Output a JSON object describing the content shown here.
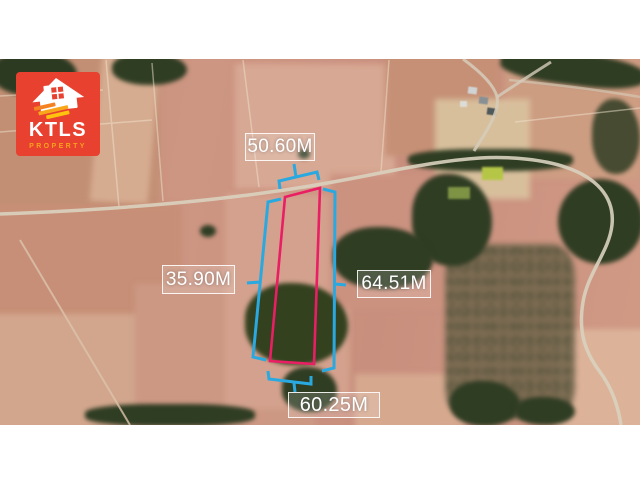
{
  "image": {
    "type": "satellite-property-listing"
  },
  "logo": {
    "brand": "KTLS",
    "tagline": "PROPERTY",
    "background_color": "#e8412f",
    "icon": "house-icon",
    "brand_color": "#ffffff",
    "tagline_color": "#f9a11d",
    "stripe_colors": [
      "#f58220",
      "#faa61a",
      "#ffc20e"
    ]
  },
  "annotations": {
    "dimension_color": "#2aa9e0",
    "boundary_color": "#e91e63",
    "label_text_color": "#ffffff",
    "labels": {
      "top": "50.60M",
      "left": "35.90M",
      "right": "64.51M",
      "bottom": "60.25M"
    }
  }
}
